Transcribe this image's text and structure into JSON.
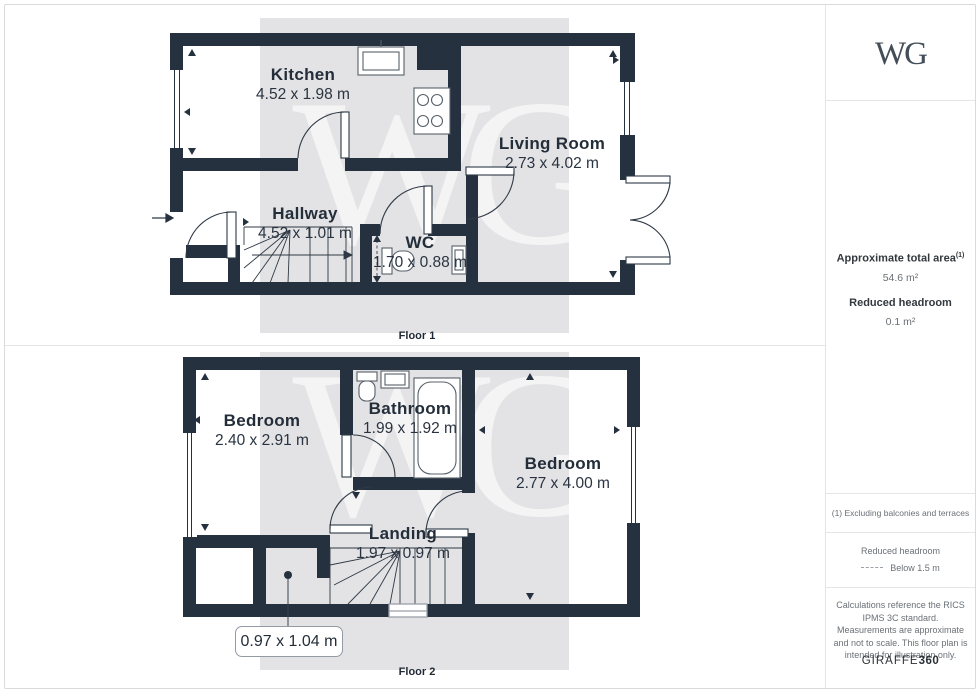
{
  "branding": {
    "logo": "WG",
    "giraffe": "GIRAFFE",
    "giraffe_suffix": "360"
  },
  "watermark": "WG",
  "sidebar": {
    "approx_area_label": "Approximate total area",
    "approx_area_sup": "(1)",
    "approx_area_value": "54.6 m²",
    "reduced_headroom_label": "Reduced headroom",
    "reduced_headroom_value": "0.1 m²",
    "footnote": "(1) Excluding balconies and terraces",
    "legend_title": "Reduced headroom",
    "legend_value": "Below 1.5 m",
    "disclaimer": "Calculations reference the RICS IPMS 3C standard. Measurements are approximate and not to scale. This floor plan is intended for illustration only."
  },
  "floor1": {
    "label": "Floor 1",
    "rooms": [
      {
        "name": "Kitchen",
        "dims": "4.52 x 1.98 m"
      },
      {
        "name": "Living Room",
        "dims": "2.73 x 4.02 m"
      },
      {
        "name": "Hallway",
        "dims": "4.52 x 1.01 m"
      },
      {
        "name": "WC",
        "dims": "1.70 x 0.88 m"
      }
    ]
  },
  "floor2": {
    "label": "Floor 2",
    "rooms": [
      {
        "name": "Bedroom",
        "dims": "2.40 x 2.91 m"
      },
      {
        "name": "Bathroom",
        "dims": "1.99 x 1.92 m"
      },
      {
        "name": "Bedroom",
        "dims": "2.77 x 4.00 m"
      },
      {
        "name": "Landing",
        "dims": "1.97 x 0.97 m"
      }
    ],
    "callout": "0.97 x 1.04 m"
  },
  "colors": {
    "wall": "#263140",
    "band": "#e3e3e5",
    "divider": "#e4e5e7",
    "text_dark": "#242e3a",
    "text_gray": "#6a7076"
  }
}
